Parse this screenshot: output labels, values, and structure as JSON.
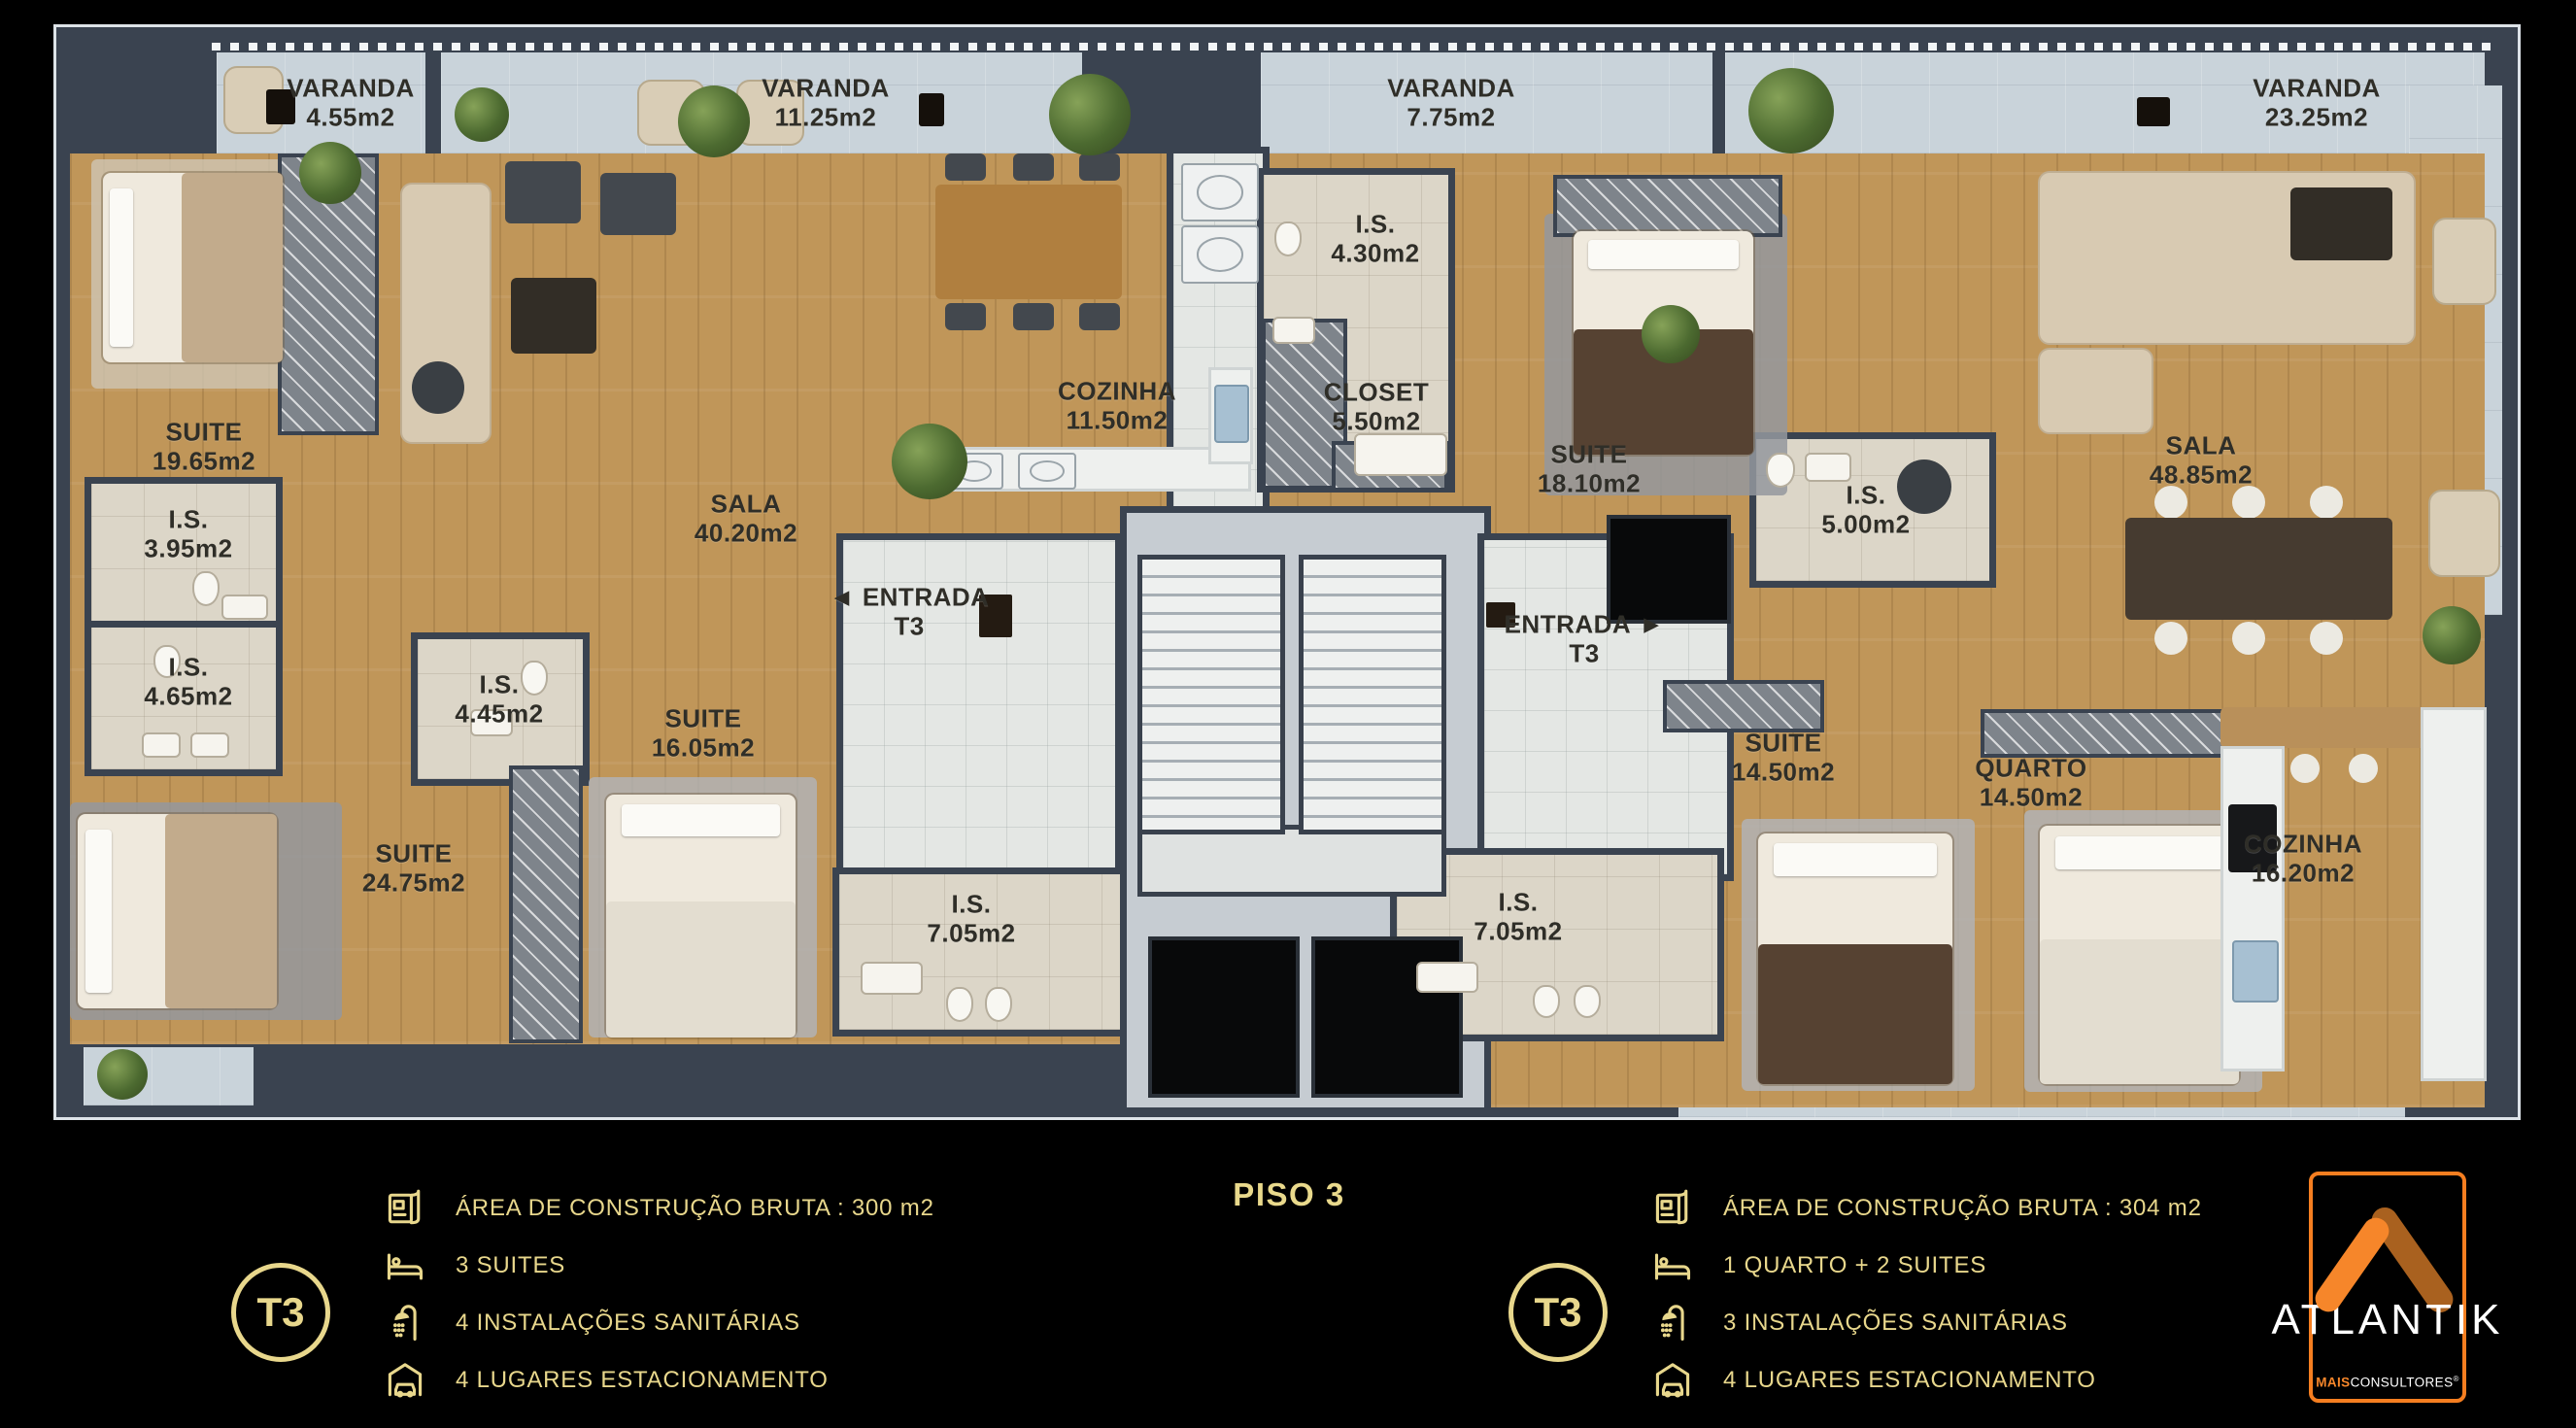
{
  "piso_label": "PISO 3",
  "plan": {
    "varandas": [
      {
        "name": "VARANDA",
        "area": "4.55m2"
      },
      {
        "name": "VARANDA",
        "area": "11.25m2"
      },
      {
        "name": "VARANDA",
        "area": "7.75m2"
      },
      {
        "name": "VARANDA",
        "area": "23.25m2"
      }
    ],
    "left_unit": {
      "rooms": [
        {
          "name": "SUITE",
          "area": "19.65m2"
        },
        {
          "name": "I.S.",
          "area": "3.95m2"
        },
        {
          "name": "I.S.",
          "area": "4.65m2"
        },
        {
          "name": "I.S.",
          "area": "4.45m2"
        },
        {
          "name": "SUITE",
          "area": "24.75m2"
        },
        {
          "name": "SUITE",
          "area": "16.05m2"
        },
        {
          "name": "SALA",
          "area": "40.20m2"
        },
        {
          "name": "COZINHA",
          "area": "11.50m2"
        },
        {
          "name": "ENTRADA",
          "area": "T3"
        },
        {
          "name": "I.S.",
          "area": "7.05m2"
        }
      ]
    },
    "right_unit": {
      "rooms": [
        {
          "name": "I.S.",
          "area": "4.30m2"
        },
        {
          "name": "CLOSET",
          "area": "5.50m2"
        },
        {
          "name": "SUITE",
          "area": "18.10m2"
        },
        {
          "name": "I.S.",
          "area": "5.00m2"
        },
        {
          "name": "SALA",
          "area": "48.85m2"
        },
        {
          "name": "ENTRADA",
          "area": "T3"
        },
        {
          "name": "I.S.",
          "area": "7.05m2"
        },
        {
          "name": "SUITE",
          "area": "14.50m2"
        },
        {
          "name": "QUARTO",
          "area": "14.50m2"
        },
        {
          "name": "COZINHA",
          "area": "16.20m2"
        }
      ]
    },
    "entrance_arrow_left": "◄",
    "entrance_arrow_right": "►"
  },
  "legends": {
    "left": {
      "badge": "T3",
      "items": [
        {
          "icon": "blueprint-icon",
          "label": "ÁREA DE CONSTRUÇÃO BRUTA :  300 m2"
        },
        {
          "icon": "bed-icon",
          "label": "3 SUITES"
        },
        {
          "icon": "shower-icon",
          "label": "4 INSTALAÇÕES SANITÁRIAS"
        },
        {
          "icon": "car-garage-icon",
          "label": "4 LUGARES ESTACIONAMENTO"
        }
      ]
    },
    "right": {
      "badge": "T3",
      "items": [
        {
          "icon": "blueprint-icon",
          "label": "ÁREA DE CONSTRUÇÃO BRUTA :  304 m2"
        },
        {
          "icon": "bed-icon",
          "label": "1 QUARTO + 2 SUITES"
        },
        {
          "icon": "shower-icon",
          "label": "3 INSTALAÇÕES SANITÁRIAS"
        },
        {
          "icon": "car-garage-icon",
          "label": "4 LUGARES ESTACIONAMENTO"
        }
      ]
    }
  },
  "logo": {
    "name": "ATLANTIK",
    "sub_bold": "MAIS",
    "sub_rest": "CONSULTORES",
    "registered": "®"
  },
  "colors": {
    "background": "#000000",
    "gold": "#e8d78c",
    "logo_orange": "#f6862a",
    "logo_dark_orange": "#a9611f",
    "wall": "#3a4350",
    "wood": "#c09659",
    "concrete": "#c9d3da"
  }
}
